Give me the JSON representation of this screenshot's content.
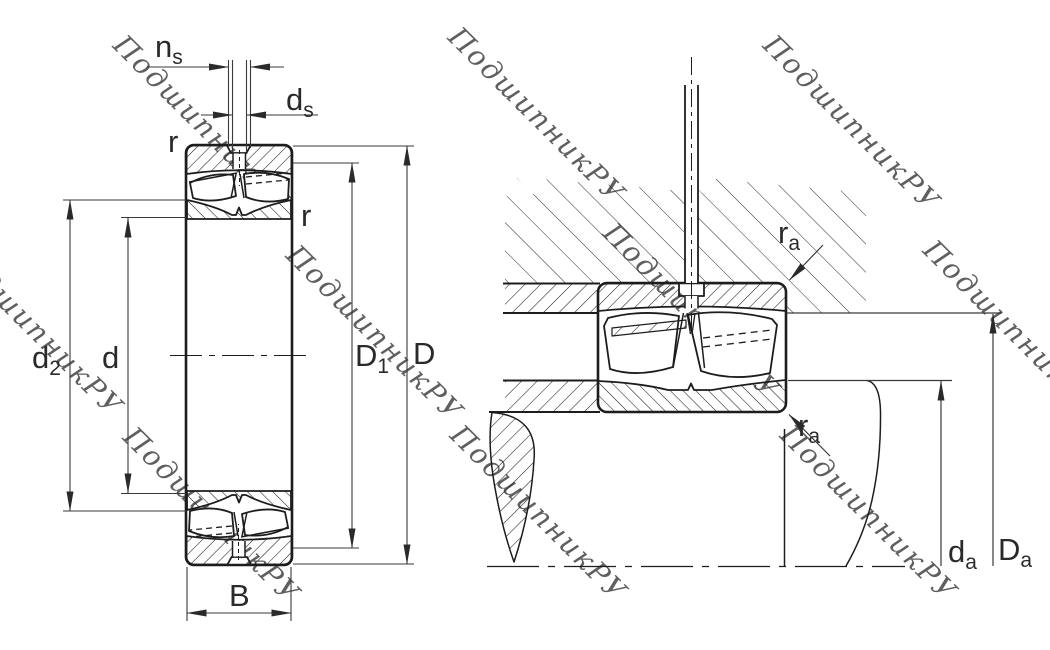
{
  "drawing": {
    "type": "bearing-cross-section-technical-drawing",
    "views": [
      "full-section-view",
      "mounted-abutment-view"
    ]
  },
  "watermark": {
    "text": "ПодшипникРУ",
    "color": "#c6c6c6"
  },
  "dimension_labels": {
    "left_view": {
      "ns_base": "n",
      "ns_sub": "s",
      "ds_base": "d",
      "ds_sub": "s",
      "r_top": "r",
      "r_side": "r",
      "d2_base": "d",
      "d2_sub": "2",
      "d": "d",
      "D1_base": "D",
      "D1_sub": "1",
      "D": "D",
      "B": "B"
    },
    "right_view": {
      "ra_top_base": "r",
      "ra_top_sub": "a",
      "ra_bottom_base": "r",
      "ra_bottom_sub": "a",
      "da_base": "d",
      "da_sub": "a",
      "Da_base": "D",
      "Da_sub": "a"
    }
  },
  "colors": {
    "background": "#ffffff",
    "part_line": "#1d1d1b",
    "dimension_line": "#3a3a3a",
    "watermark": "#c6c6c6"
  }
}
